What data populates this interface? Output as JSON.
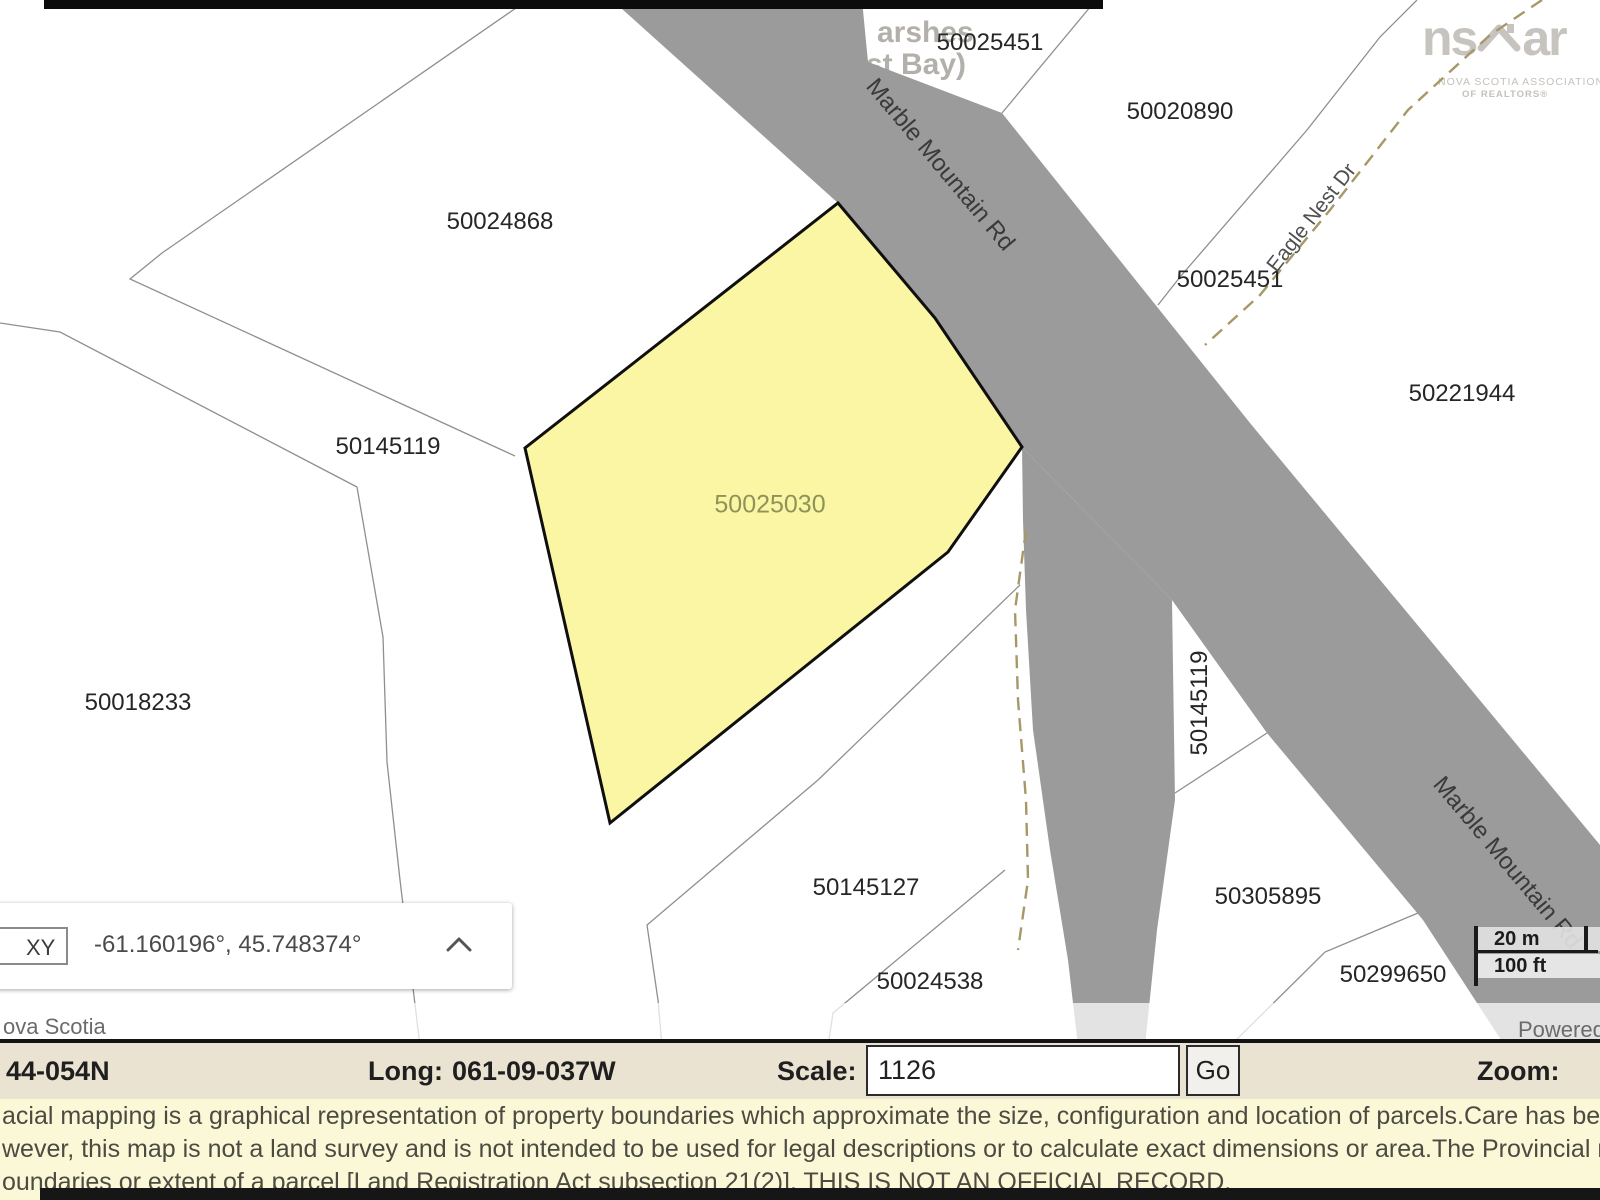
{
  "map": {
    "parcels": [
      {
        "id": "50025451"
      },
      {
        "id": "50020890"
      },
      {
        "id": "50025451"
      },
      {
        "id": "50221944"
      },
      {
        "id": "50024868"
      },
      {
        "id": "50145119"
      },
      {
        "id": "50025030"
      },
      {
        "id": "50018233"
      },
      {
        "id": "50145119"
      },
      {
        "id": "50145127"
      },
      {
        "id": "50305895"
      },
      {
        "id": "50024538"
      },
      {
        "id": "50299650"
      }
    ],
    "roads": [
      {
        "name": "Marble Mountain Rd"
      },
      {
        "name": "Marble Mountain Rd"
      },
      {
        "name": "Eagle Nest Dr"
      }
    ],
    "water_label": {
      "fragment1": "arshes",
      "fragment2": "st Bay)"
    },
    "highlighted_parcel": "50025030",
    "colors": {
      "road_fill": "#9b9b9b",
      "highlight_fill": "#faf6a3",
      "highlight_outline": "#0f0f0f",
      "highlight_label": "#8f935a",
      "dashed_road": "#a79867",
      "boundary_line": "#8f8f8f"
    }
  },
  "scalebar": {
    "metric": "20 m",
    "imperial": "100 ft"
  },
  "coordinate_widget": {
    "mode_label": "XY",
    "coordinates": "-61.160196°, 45.748374°"
  },
  "attribution": {
    "left": "ova Scotia",
    "right": "Powered"
  },
  "logo": {
    "ns": "ns",
    "ar": "ar",
    "line1": "NOVA SCOTIA ASSOCIATION",
    "line2": "OF REALTORS®"
  },
  "statusbar": {
    "lat_value": "44-054N",
    "long_label": "Long:",
    "long_value": "061-09-037W",
    "scale_label": "Scale:",
    "scale_value": "1126",
    "go_label": "Go",
    "zoom_label": "Zoom:"
  },
  "disclaimer": {
    "lines": [
      "acial mapping is a graphical representation of property boundaries which approximate the size, configuration and location of parcels.Care has been taken to ensure the best po",
      "wever, this map is not a land survey and is not intended to be used for legal descriptions or to calculate exact dimensions or area.The Provincial mapping is not conclusive as t",
      "oundaries or extent of a parcel [Land Registration Act subsection 21(2)]. THIS IS NOT AN OFFICIAL RECORD."
    ]
  }
}
